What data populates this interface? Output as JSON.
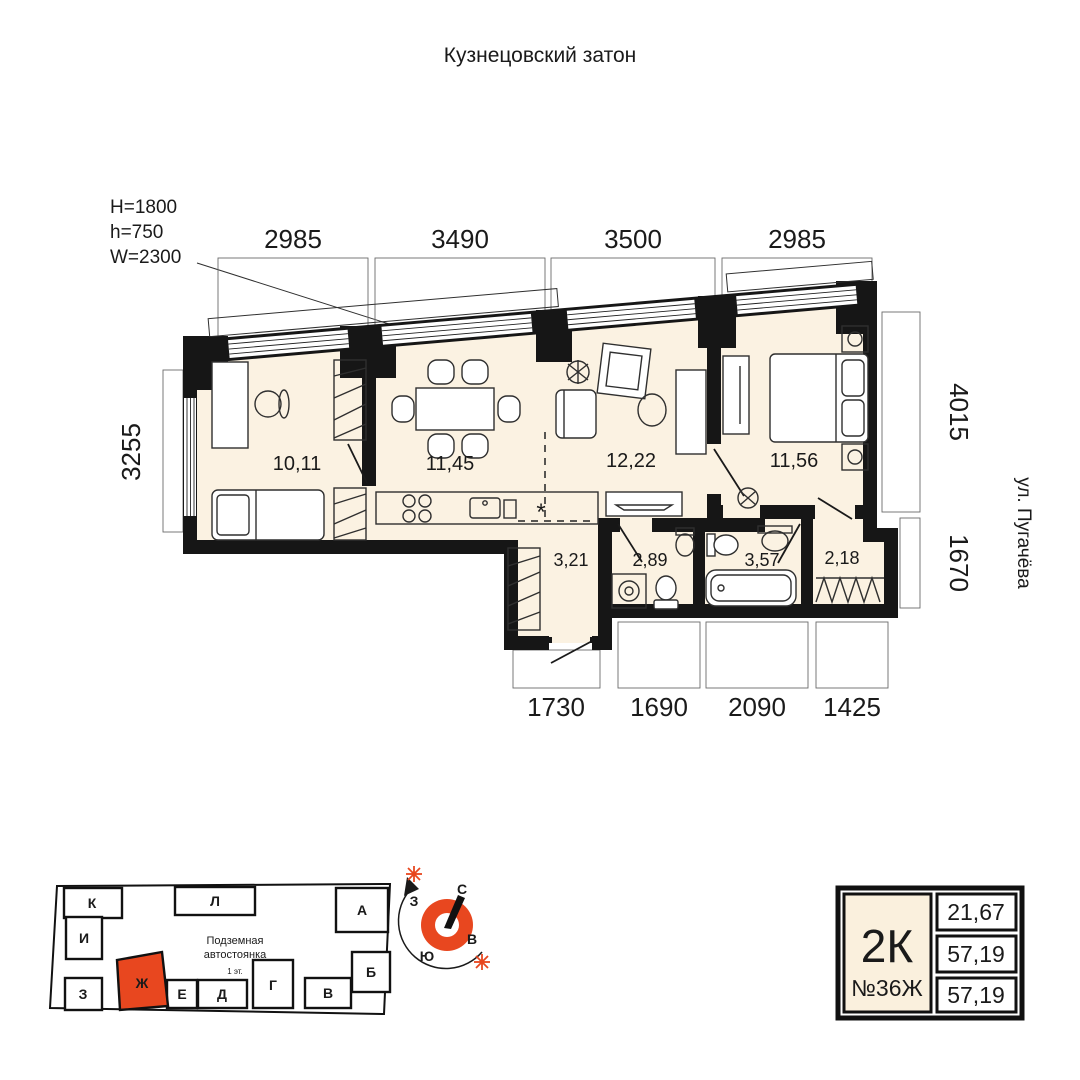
{
  "title": "Кузнецовский затон",
  "window_spec": {
    "h_big": "H=1800",
    "h_small": "h=750",
    "w": "W=2300"
  },
  "dimensions": {
    "top": [
      "2985",
      "3490",
      "3500",
      "2985"
    ],
    "left": "3255",
    "right_upper": "4015",
    "right_lower": "1670",
    "bottom": [
      "1730",
      "1690",
      "2090",
      "1425"
    ],
    "street": "ул. Пугачёва"
  },
  "rooms": {
    "bedroom1": "10,11",
    "kitchen_living": "11,45",
    "living": "12,22",
    "bedroom2": "11,56",
    "hall": "3,21",
    "wc": "2,89",
    "bathroom": "3,57",
    "wardrobe": "2,18",
    "kitchen_marker": "*"
  },
  "site_plan": {
    "parking_label_1": "Подземная",
    "parking_label_2": "автостоянка",
    "parking_sub": "1 эт.",
    "blocks": [
      "К",
      "И",
      "З",
      "Л",
      "А",
      "Б",
      "В",
      "Г",
      "Д",
      "Е",
      "Ж"
    ],
    "highlighted_block": "Ж"
  },
  "compass": {
    "north": "С",
    "south": "Ю",
    "west": "З",
    "east": "В"
  },
  "unit_card": {
    "type": "2К",
    "number": "№36Ж",
    "rows": [
      "21,67",
      "57,19",
      "57,19"
    ]
  },
  "colors": {
    "floor": "#fbf2e2",
    "wall": "#161616",
    "accent": "#e8471f",
    "card_fill": "#faf0dd"
  }
}
